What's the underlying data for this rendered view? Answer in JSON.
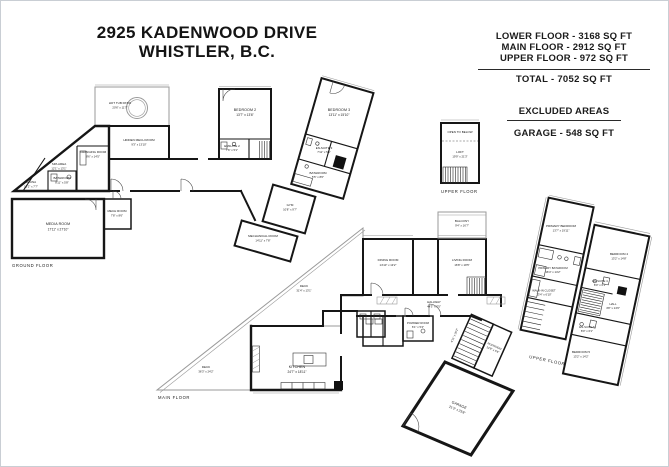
{
  "title": {
    "line1": "2925 KADENWOOD DRIVE",
    "line2": "WHISTLER, B.C."
  },
  "area_summary": {
    "lower_floor": "LOWER FLOOR - 3168 SQ FT",
    "main_floor": "MAIN FLOOR - 2912 SQ FT",
    "upper_floor": "UPPER FLOOR - 972 SQ FT",
    "total": "TOTAL  -  7052 SQ FT",
    "excluded_heading": "EXCLUDED AREAS",
    "excluded_garage": "GARAGE - 548 SQ FT"
  },
  "floor_labels": {
    "ground": "GROUND FLOOR",
    "main": "MAIN FLOOR",
    "upper_box": "UPPER FLOOR",
    "upper_wing": "UPPER FLOOR"
  },
  "rooms": {
    "hot_tub_patio": {
      "name": "HOT TUB PATIO",
      "dims": "20'6\" x 11'7\""
    },
    "hidden_mech": {
      "name": "HIDDEN MECH ROOM",
      "dims": "9'3\" x 13'10\""
    },
    "changing": {
      "name": "CHANGING ROOM",
      "dims": "8'6\" x 14'5\""
    },
    "spa": {
      "name": "SPA AREA",
      "dims": "12'1\" x 13'1\""
    },
    "sauna": {
      "name": "SAUNA",
      "dims": "10'2\" x 7'7\""
    },
    "bath_lower": {
      "name": "BATHROOM",
      "dims": "8'11\" x 5'8\""
    },
    "media": {
      "name": "MEDIA ROOM",
      "dims": "17'11\" x 27'10\""
    },
    "mech": {
      "name": "MECH ROOM",
      "dims": "7'8\" x 8'6\""
    },
    "bedroom2": {
      "name": "BEDROOM 2",
      "dims": "13'7\" x 13'6\""
    },
    "ensuite2": {
      "name": "ENSUITE 2",
      "dims": "7'6\" x 5'1\""
    },
    "bedroom3": {
      "name": "BEDROOM 3",
      "dims": "13'11\" x 15'10\""
    },
    "ensuite3": {
      "name": "EN-SUITE 3",
      "dims": "7'11\" x 5'1\""
    },
    "bath_wing": {
      "name": "BATHROOM",
      "dims": "5'5\" x 8'0\""
    },
    "gym": {
      "name": "GYM",
      "dims": "10'8\" x 9'7\""
    },
    "mechanical": {
      "name": "MECHANICAL ROOM",
      "dims": "14'11\" x 7'8\""
    },
    "open_below": {
      "name": "OPEN TO BELOW"
    },
    "loft": {
      "name": "LOFT",
      "dims": "19'9\" x 21'3\""
    },
    "deck_upper": {
      "name": "DECK",
      "dims": "31'4\" x 13'1\""
    },
    "deck_lower": {
      "name": "DECK",
      "dims": "36'3\" x 24'2\""
    },
    "kitchen": {
      "name": "KITCHEN",
      "dims": "24'7\" x 18'11\""
    },
    "dining": {
      "name": "DINING ROOM",
      "dims": "14'10\" x 13'2\""
    },
    "living": {
      "name": "LIVING ROOM",
      "dims": "16'8\" x 19'5\""
    },
    "balcony": {
      "name": "BALCONY",
      "dims": "9'4\" x 16'7\""
    },
    "hallway": {
      "name": "HALLWAY",
      "dims": "44'3\" x 7'5\""
    },
    "powder": {
      "name": "POWDER ROOM",
      "dims": "6'1\" x 5'4\""
    },
    "mudroom": {
      "name": "MUDROOM",
      "dims": "14'8\" x 5'6\""
    },
    "stair_hall": {
      "dims": "4'11\" x 20'2\""
    },
    "garage": {
      "name": "GARAGE",
      "dims": "21'3\" x 23'8\""
    },
    "primary_bedroom": {
      "name": "PRIMARY BEDROOM",
      "dims": "13'7\" x 19'11\""
    },
    "primary_bathroom": {
      "name": "PRIMARY BATHROOM",
      "dims": "16'4\" x 14'2\""
    },
    "wic": {
      "name": "WALK-IN CLOSET",
      "dims": "13'4\" x 6'10\""
    },
    "bedroom4": {
      "name": "BEDROOM 4",
      "dims": "13'2\" x 14'8\""
    },
    "ensuite4": {
      "name": "EN-SUITE 4",
      "dims": "8'0\" x 6'1\""
    },
    "hall": {
      "name": "HALL",
      "dims": "4'8\" x 14'6\""
    },
    "ensuite5": {
      "name": "EN-SUITE 5",
      "dims": "8'0\" x 6'1\""
    },
    "bedroom5": {
      "name": "BEDROOM 5",
      "dims": "13'2\" x 14'2\""
    }
  }
}
